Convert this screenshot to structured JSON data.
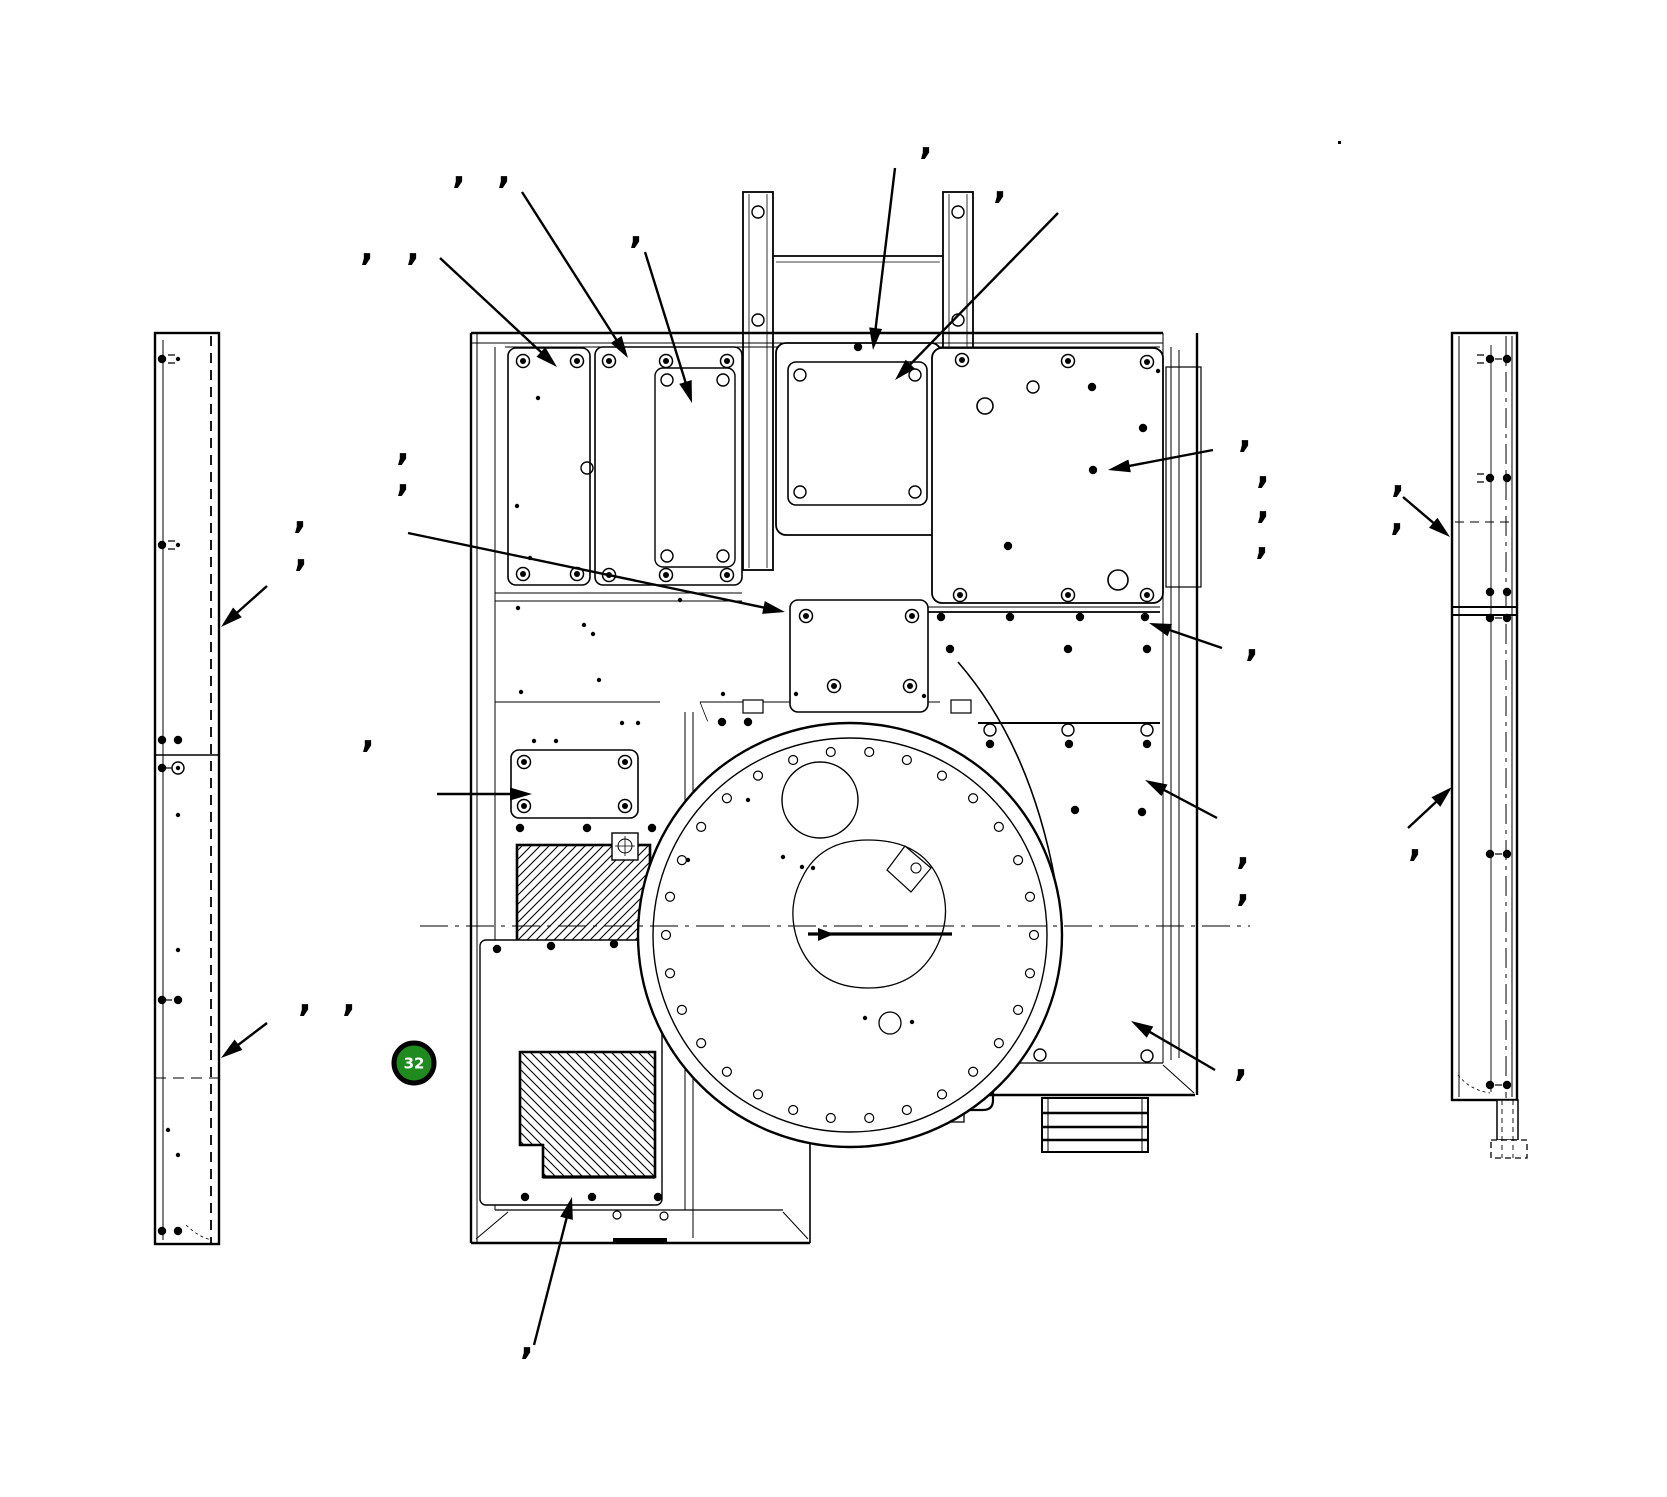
{
  "figure": {
    "type": "technical-exploded-parts-drawing",
    "background": "#ffffff",
    "line_color": "#000000",
    "canvas": {
      "width": 1667,
      "height": 1497
    }
  },
  "callout_badge": {
    "label": "32",
    "x": 414,
    "y": 1063,
    "radius": 20,
    "fill": "#1f8b1f",
    "ring_color": "#000000",
    "text_color": "#ffffff"
  },
  "callout_marks": {
    "glyph": ",",
    "color": "#000000",
    "font_size": 36,
    "positions": [
      [
        459,
        189
      ],
      [
        504,
        189
      ],
      [
        367,
        266
      ],
      [
        413,
        266
      ],
      [
        636,
        249
      ],
      [
        926,
        160
      ],
      [
        1000,
        204
      ],
      [
        403,
        466
      ],
      [
        403,
        497
      ],
      [
        300,
        534
      ],
      [
        301,
        572
      ],
      [
        368,
        753
      ],
      [
        305,
        1017
      ],
      [
        349,
        1017
      ],
      [
        527,
        1360
      ],
      [
        1245,
        453
      ],
      [
        1263,
        489
      ],
      [
        1263,
        524
      ],
      [
        1262,
        560
      ],
      [
        1252,
        662
      ],
      [
        1243,
        870
      ],
      [
        1243,
        907
      ],
      [
        1241,
        1082
      ],
      [
        1398,
        498
      ],
      [
        1397,
        536
      ],
      [
        1415,
        862
      ]
    ]
  },
  "tick_dot": {
    "x": 1338,
    "y": 141
  },
  "leader_arrows": [
    {
      "name": "arrow-top-left-panel-1",
      "x1": 440,
      "y1": 258,
      "x2": 557,
      "y2": 367
    },
    {
      "name": "arrow-top-left-panel-2",
      "x1": 522,
      "y1": 192,
      "x2": 628,
      "y2": 358
    },
    {
      "name": "arrow-top-left-panel-inner",
      "x1": 645,
      "y1": 252,
      "x2": 692,
      "y2": 403
    },
    {
      "name": "arrow-center-square-panel-a",
      "x1": 895,
      "y1": 168,
      "x2": 873,
      "y2": 350
    },
    {
      "name": "arrow-center-square-panel-b",
      "x1": 1058,
      "y1": 213,
      "x2": 895,
      "y2": 380
    },
    {
      "name": "arrow-right-large-panel",
      "x1": 1213,
      "y1": 450,
      "x2": 1108,
      "y2": 470
    },
    {
      "name": "arrow-right-mid-panel",
      "x1": 1222,
      "y1": 648,
      "x2": 1149,
      "y2": 623
    },
    {
      "name": "arrow-right-lower-panel",
      "x1": 1217,
      "y1": 818,
      "x2": 1145,
      "y2": 780
    },
    {
      "name": "arrow-right-bottom-panel",
      "x1": 1215,
      "y1": 1070,
      "x2": 1131,
      "y2": 1021
    },
    {
      "name": "arrow-center-access-panel",
      "x1": 408,
      "y1": 533,
      "x2": 785,
      "y2": 612
    },
    {
      "name": "arrow-mid-left-panel",
      "x1": 437,
      "y1": 794,
      "x2": 532,
      "y2": 794
    },
    {
      "name": "arrow-bottom-panel",
      "x1": 534,
      "y1": 1345,
      "x2": 572,
      "y2": 1197
    },
    {
      "name": "arrow-left-side-panel-upper",
      "x1": 267,
      "y1": 586,
      "x2": 221,
      "y2": 627
    },
    {
      "name": "arrow-left-side-panel-lower",
      "x1": 267,
      "y1": 1023,
      "x2": 221,
      "y2": 1058
    },
    {
      "name": "arrow-right-side-panel-upper",
      "x1": 1403,
      "y1": 497,
      "x2": 1450,
      "y2": 537
    },
    {
      "name": "arrow-right-side-panel-lower",
      "x1": 1408,
      "y1": 828,
      "x2": 1452,
      "y2": 787
    }
  ]
}
